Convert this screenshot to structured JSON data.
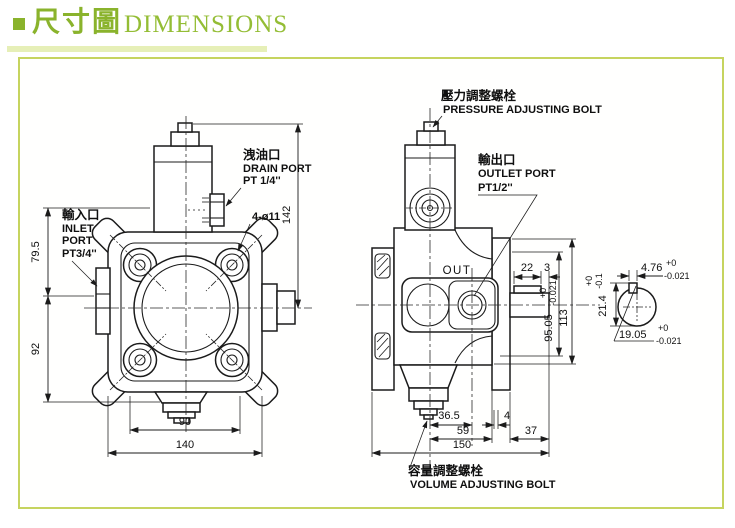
{
  "header": {
    "title_zh": "尺寸圖",
    "title_en": "DIMENSIONS"
  },
  "colors": {
    "accent_green": "#8ab32c",
    "underline_bar": "#e6efb7",
    "frame_border": "#c6d45f",
    "line": "#1b1b1b"
  },
  "annotations": {
    "pressure": {
      "zh": "壓力調整螺栓",
      "en": "PRESSURE ADJUSTING BOLT"
    },
    "drain": {
      "zh": "洩油口",
      "en": "DRAIN PORT",
      "size": "PT 1/4''"
    },
    "inlet": {
      "zh": "輸入口",
      "en1": "INLET",
      "en2": "PORT",
      "size": "PT3/4''"
    },
    "outlet": {
      "zh": "輸出口",
      "en": "OUTLET PORT",
      "size": "PT1/2''"
    },
    "volume": {
      "zh": "容量調整螺栓",
      "en": "VOLUME ADJUSTING BOLT"
    },
    "out_marking": "OUT",
    "mount_holes": "4-ø11"
  },
  "dims": {
    "front": {
      "overall_height": "142",
      "upper_left": "79.5",
      "lower_left": "92",
      "bolt_spacing": "90",
      "overall_width": "140"
    },
    "side": {
      "key_length": "22",
      "key_to_end": "3",
      "center_height": "95.05",
      "center_height_tol_plus": "+0",
      "center_height_tol_minus": "-0.021",
      "total_height": "113",
      "bolt_offset": "36.5",
      "gap": "4",
      "body_length": "59",
      "rear_length": "37",
      "overall_length": "150"
    },
    "shaft": {
      "key_width": "4.76",
      "key_width_tol_plus": "+0",
      "key_width_tol_minus": "-0.021",
      "flat_height": "21.4",
      "flat_height_tol_plus": "+0",
      "flat_height_tol_minus": "-0.1",
      "diameter": "19.05",
      "diameter_tol_plus": "+0",
      "diameter_tol_minus": "-0.021"
    }
  }
}
